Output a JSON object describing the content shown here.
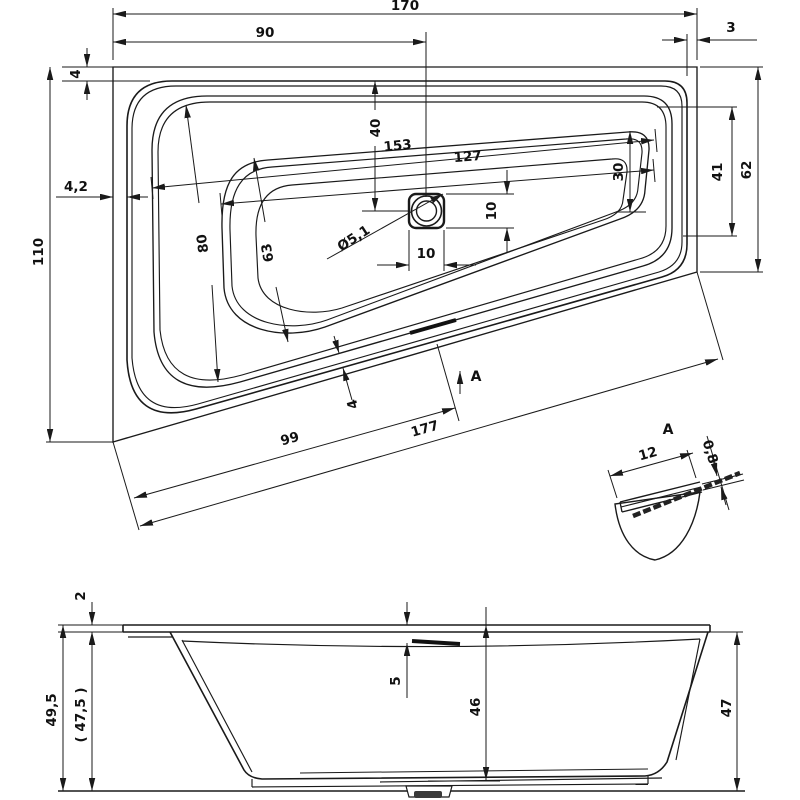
{
  "colors": {
    "ink": "#1a1a1a",
    "paper": "#ffffff"
  },
  "plan": {
    "overall_width": "170",
    "drain_offset_left": "90",
    "gap_right": "3",
    "gap_top": "4",
    "gap_left": "4,2",
    "overall_depth_left": "110",
    "overall_depth_right": "62",
    "inner_depth_right": "41",
    "basin_depth_right": "30",
    "drain_offset_top": "40",
    "inner_length": "153",
    "basin_length": "127",
    "inner_depth_left": "80",
    "basin_depth_left": "63",
    "drain_width": "10",
    "drain_height": "10",
    "drain_diameter": "Ø5,1",
    "edge_to_drain": "99",
    "edge_total": "177",
    "gap_bottom": "4",
    "section_arrow_label": "A"
  },
  "detail_a": {
    "label": "A",
    "rim_width": "12",
    "sheet_thickness": "0,8"
  },
  "elevation": {
    "rim_thickness": "2",
    "height_total": "49,5",
    "height_alt": "( 47,5 )",
    "overflow_offset": "5",
    "inner_depth": "46",
    "height_right": "47"
  }
}
